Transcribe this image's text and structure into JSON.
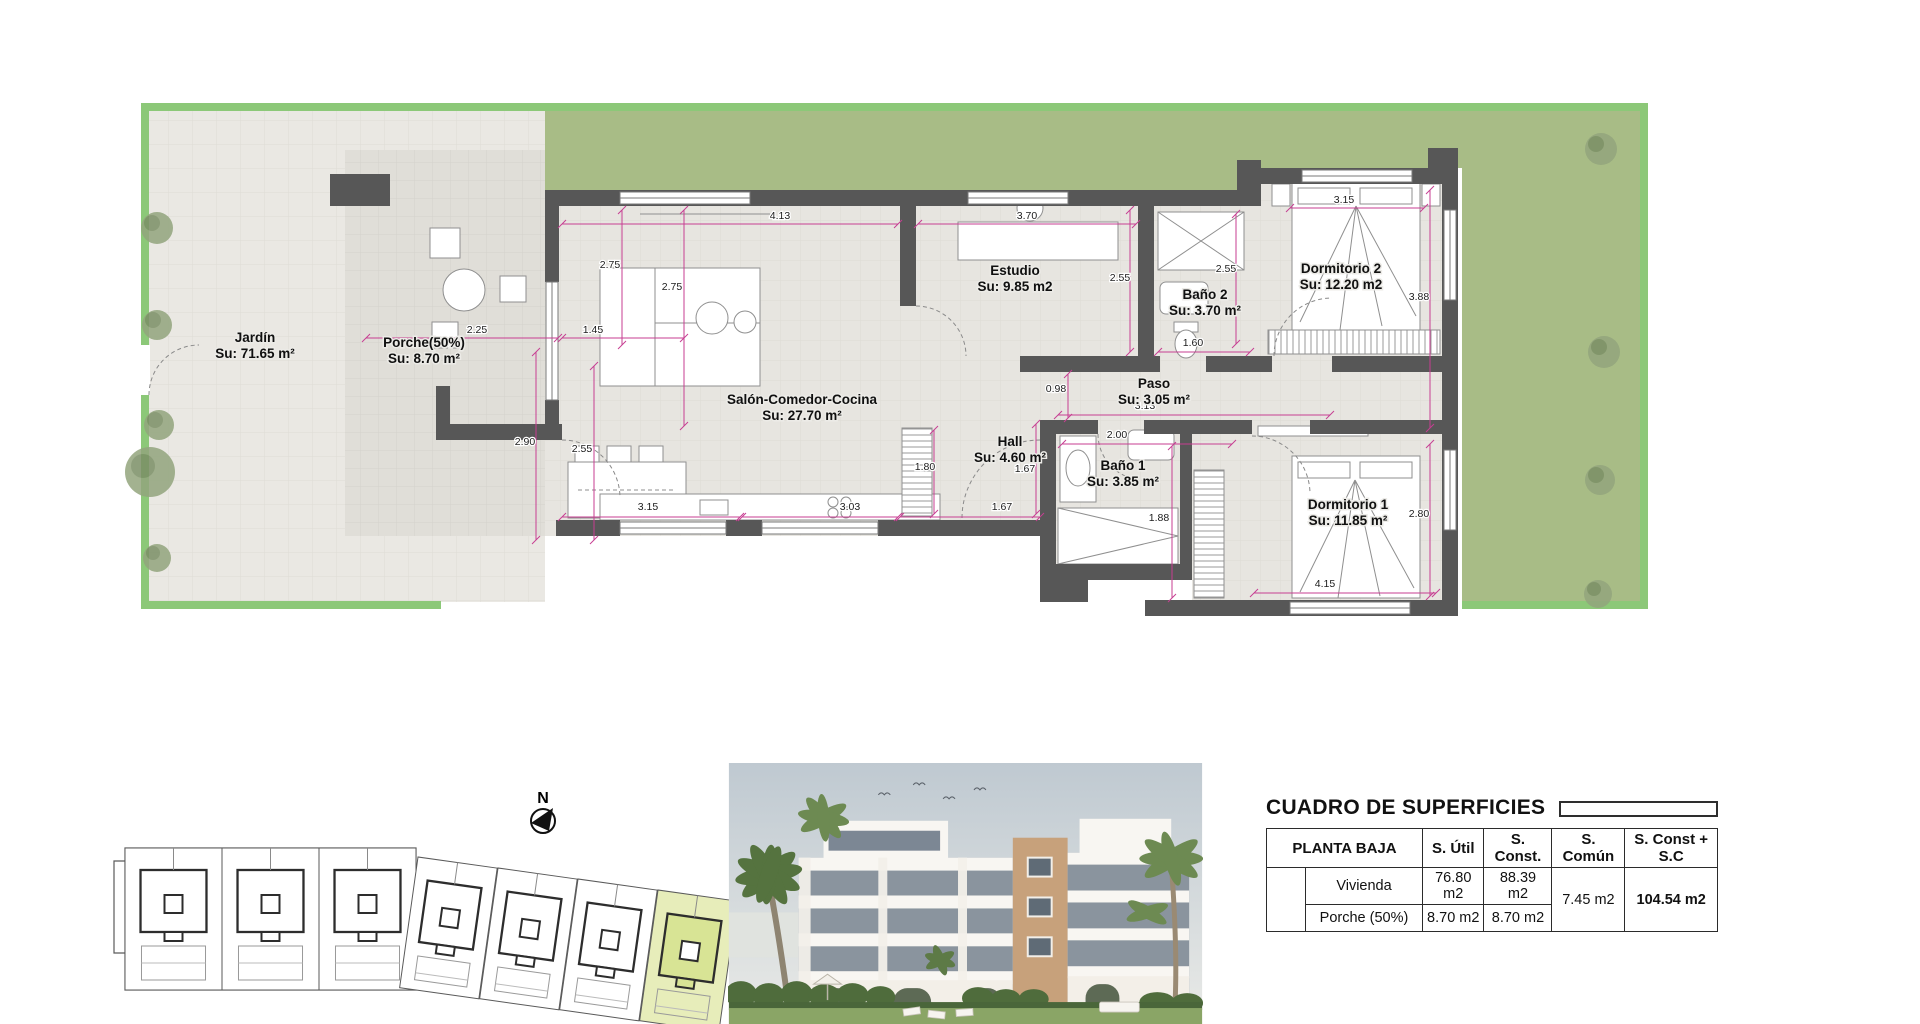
{
  "plan": {
    "north": "N",
    "rooms": [
      {
        "name": "Jardín",
        "area": "Su: 71.65 m²"
      },
      {
        "name": "Porche(50%)",
        "area": "Su: 8.70 m²"
      },
      {
        "name": "Salón-Comedor-Cocina",
        "area": "Su: 27.70 m²"
      },
      {
        "name": "Estudio",
        "area": "Su: 9.85 m2"
      },
      {
        "name": "Baño 2",
        "area": "Su: 3.70 m²"
      },
      {
        "name": "Dormitorio 2",
        "area": "Su: 12.20 m2"
      },
      {
        "name": "Paso",
        "area": "Su: 3.05 m²"
      },
      {
        "name": "Hall",
        "area": "Su: 4.60 m²"
      },
      {
        "name": "Baño 1",
        "area": "Su: 3.85 m²"
      },
      {
        "name": "Dormitorio 1",
        "area": "Su: 11.85 m²"
      }
    ],
    "dims": [
      "4.13",
      "3.70",
      "2.75",
      "2.75",
      "2.25",
      "1.45",
      "2.90",
      "2.55",
      "2.55",
      "2.55",
      "1.60",
      "3.15",
      "3.88",
      "0.98",
      "3.13",
      "2.00",
      "1.88",
      "1.67",
      "1.67",
      "3.15",
      "3.03",
      "1.80",
      "4.15",
      "2.80"
    ]
  },
  "table": {
    "title": "CUADRO DE SUPERFICIES",
    "header": {
      "planta": "PLANTA BAJA",
      "util": "S. Útil",
      "const": "S. Const.",
      "comun": "S. Común",
      "const_sc": "S. Const + S.C"
    },
    "rows": {
      "vivienda": {
        "label": "Vivienda",
        "util": "76.80 m2",
        "const": "88.39 m2"
      },
      "porche": {
        "label": "Porche (50%)",
        "util": "8.70 m2",
        "const": "8.70 m2"
      },
      "comun": "7.45 m2",
      "total": "104.54 m2"
    }
  },
  "colors": {
    "plot_border": "#8cc878",
    "grass": "#a8bc86",
    "paved": "#eae8e3",
    "paved_dark": "#e0ded8",
    "wall": "#575757",
    "dim_magenta": "#c73e92",
    "table_header_bg": "#e9edc4",
    "highlight_unit_outer": "#e7edba",
    "highlight_unit_inner": "#d8e495"
  }
}
